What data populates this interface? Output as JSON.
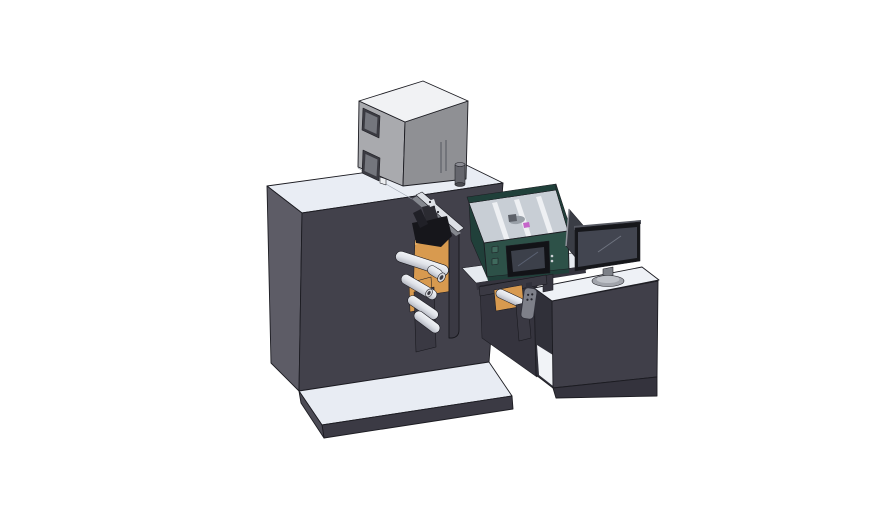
{
  "window": {
    "width": 888,
    "height": 522
  },
  "scene": {
    "kind": "cad-isometric-render",
    "subject": "roll-fed printing machine with operator desk",
    "components": {
      "top_cabinet": "equipment-cabinet",
      "machine_body": "main-machine-housing",
      "unwind_station": "roller-unwind-station",
      "print_head": "print-head-assembly",
      "process_module": "process-module-with-hmi",
      "control_pendant": "hanging-control-pendant",
      "bridge": "transfer-bridge",
      "operator_desk": "operator-desk",
      "monitor": "desktop-monitor",
      "divider_panel": "side-divider-panel",
      "base_platform": "base-platform"
    }
  },
  "colors": {
    "bg": "#ffffff",
    "outline": "#1c1c22",
    "seam": "#9aa2ad",
    "machine_top": "#e9edf4",
    "machine_left": "#5d5c66",
    "machine_front": "#42414b",
    "platform_top": "#e8ecf3",
    "platform_front": "#3b3a44",
    "platform_left": "#4c4b55",
    "box_top": "#f1f2f4",
    "box_left": "#a9aaae",
    "box_front": "#8f9094",
    "box_window_frame": "#3b3b42",
    "box_window": "#74767d",
    "box_slot": "#63646b",
    "box_foot": "#eceef1",
    "box_cyl": "#65666d",
    "box_cyl_light": "#8b8c93",
    "box_cyl_dark": "#4a4b51",
    "deck_white": "#e6eaf0",
    "under_dark": "#35343e",
    "teal_interior": "#c8ced5",
    "teal_rail": "#eef0f3",
    "teal_front": "#2d5148",
    "teal_dark": "#20403a",
    "teal_button": "#3f6a5d",
    "mech_gray": "#99a0a8",
    "mech_dark": "#5c6068",
    "magenta": "#c565c9",
    "hmi_bezel": "#121317",
    "hmi_screen": "#3c404a",
    "hmi_glint": "#5a6172",
    "hmi_dot": "#ced1d6",
    "orange": "#d89a4f",
    "orange_light": "#e9b066",
    "plate_dark": "#3a3943",
    "plate_edge": "#17171c",
    "head_black": "#16161b",
    "head_gray": "#2b2b32",
    "head_mid": "#202027",
    "rail_light": "#dde0e6",
    "rail_shadow": "#85888f",
    "roller_light": "#f2f4f7",
    "roller_mid": "#dfe2e8",
    "roller_dark": "#b3b6c0",
    "roller_cap": "#d6d8dd",
    "cap_hole": "#3c3c44",
    "desk_top": "#eef1f6",
    "desk_front": "#403f49",
    "desk_left": "#303039",
    "desk_base": "#34333d",
    "bay_white": "#f1f3f7",
    "divider": "#3a3d45",
    "divider_edge": "#8f929a",
    "monitor_top": "#565962",
    "monitor_bezel": "#16171b",
    "monitor_screen": "#424550",
    "monitor_glint": "#6f7480",
    "stand": "#7d8087",
    "stand_base": "#a1a4ab",
    "stand_base_top": "#bfc2c8",
    "pendant": "#7e8089",
    "pendant_dark": "#30303a",
    "dot_dark": "#25252c"
  }
}
